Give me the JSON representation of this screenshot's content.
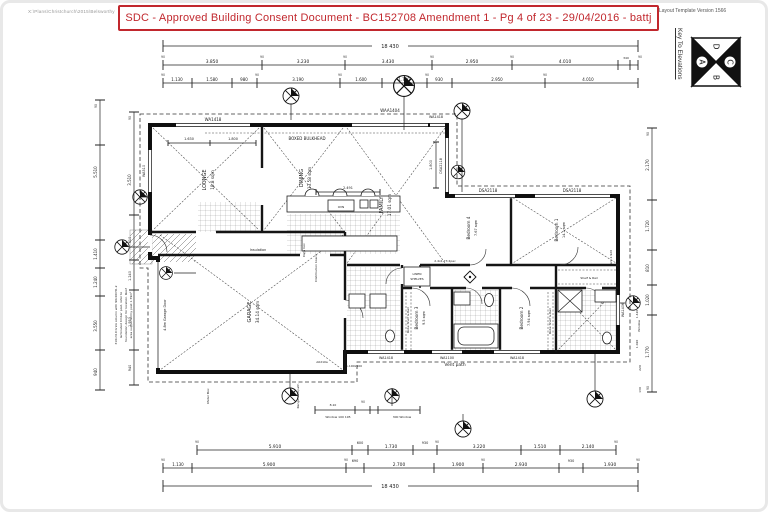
{
  "page": {
    "file_path": "X:\\Plans\\Christchurch\\2015\\Belsworthy",
    "stamp_text": "SDC  -  Approved Building Consent Document  -  BC152708 Amendment 1  -  Pg 4 of 23  -  29/04/2016  -  battj",
    "stamp_color": "#c1272d",
    "template_version": "Layout Template Version 1566",
    "key_title": "Key To Elevations",
    "key_letters": {
      "top": "D",
      "right": "C",
      "bottom": "B",
      "left": "A"
    }
  },
  "dims": {
    "overall": "18 430",
    "ninety": "90",
    "top_row2": [
      "3.850",
      "3.230",
      "3.430",
      "2.950",
      "4.010",
      "340"
    ],
    "top_row3": [
      "1.130",
      "1.580",
      "980",
      "3.190",
      "1.600",
      "1.720",
      "930",
      "2.950",
      "4.010"
    ],
    "bottom_row1": [
      "5.910",
      "600",
      "1.730",
      "930",
      "3.220",
      "1.510",
      "2.140"
    ],
    "bottom_row2": [
      "1.130",
      "5.900",
      "690",
      "2.700",
      "1.900",
      "2.930",
      "930",
      "1.930"
    ],
    "left_outer": [
      "5.510",
      "1.410",
      "1.240",
      "3.550",
      "940"
    ],
    "left_inner": [
      "3.510",
      "610",
      "1.240",
      "1.953",
      "940"
    ],
    "right": [
      "2.170",
      "1.720",
      "810",
      "1.020",
      "1.770"
    ],
    "right_small": [
      "1.420",
      "1.020",
      "220",
      "130"
    ],
    "lounge_a": "1.630",
    "lounge_b": "1.800",
    "kitchen_w": "2.491",
    "kitchen_h": "1.800",
    "win_note_top": "8.10",
    "win_note_left": "Window 100 195",
    "win_note_right": "300 Window"
  },
  "rooms": {
    "lounge": {
      "name": "LOUNGE",
      "area": "18.8 sqm"
    },
    "dining": {
      "name": "DINING",
      "area": "13.58 sqm"
    },
    "family": {
      "name": "FAMILY",
      "area": "17.01 sqm"
    },
    "garage": {
      "name": "GARAGE",
      "area": "34.14 sqm"
    },
    "bed1": {
      "name": "Bedroom 1",
      "area": "14.1 sqm"
    },
    "bed2": {
      "name": "Bedroom 2",
      "area": "7.94 sqm"
    },
    "bed3": {
      "name": "Bedroom 3",
      "area": "9.5 sqm"
    },
    "bed4": {
      "name": "Bedroom 4",
      "area": "7.67 sqm"
    }
  },
  "labels": {
    "wa1418_a": "WA1418",
    "waa1404": "WAA1404",
    "wa1418_b": "WA1418",
    "dsa2118_a": "DSA2118",
    "dsa2118_b": "DSA2118",
    "dsa2118_c": "DSA2118",
    "wa1418_c": "WA1418",
    "wa1100": "WA1100",
    "wa1418_d": "WA1418",
    "wa1406": "WA1406",
    "wa510": "WA510",
    "a0210a": "A0210a",
    "boxed_bulkhead": "BOXED BULKHEAD",
    "insulation": "Insulation",
    "vent_path": "Vent path",
    "vent_right": "Vent 2.920",
    "linen_1": "LINEN",
    "linen_2": "SHELVES",
    "robe_left": "Robe Shelf & Rail",
    "robe_right": "Robe Shelf & Rail",
    "shelf_rail": "Shelf & Rail",
    "robe_note": "2.4x1.73 2pac",
    "oven": "OVN",
    "dist_board": "Distribution board",
    "data_box": "Data box",
    "meter_box": "Meter Box",
    "rangehood": "Rangehood path",
    "garage_door": "4.8m Garage Door",
    "window_small": "Window",
    "size_note": "1.100x500",
    "column_note_1": "310x310 brick column with 90x90 H1.2",
    "column_note_2": "laminated timber post, refer to",
    "column_note_3": "foundation design for location. Roof",
    "column_note_4": "area supported by post 1.79m²"
  }
}
